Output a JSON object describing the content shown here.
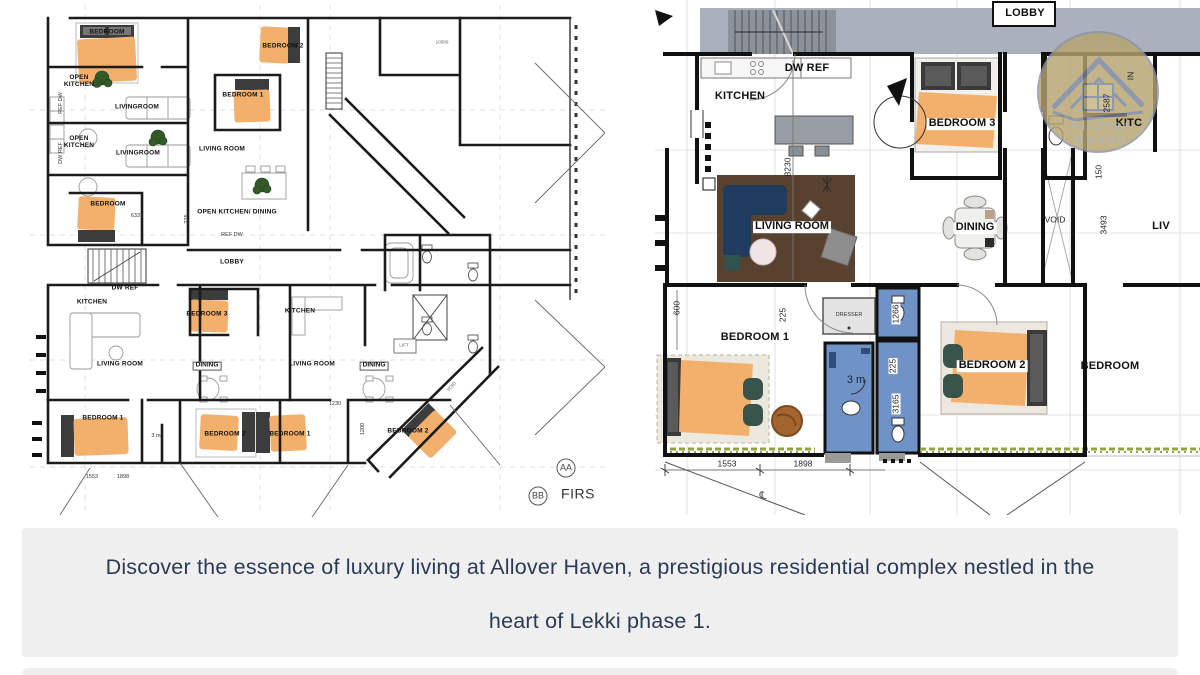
{
  "caption": {
    "lines": [
      "Discover the essence of luxury living at Allover Haven, a prestigious residential complex nestled in the",
      "heart of Lekki phase 1."
    ],
    "text_color": "#2b3a55",
    "bg_color": "#efeff0"
  },
  "brand": {
    "watermark": "Allover Haven"
  },
  "colors": {
    "bed_orange": "#f2b06c",
    "bath_blue": "#6f93c6",
    "rug_brown": "#58422f",
    "sofa_navy": "#203c5e",
    "lobby_gray": "#aab1bd",
    "stairs_gray": "#8d9199",
    "watermark_tan": "#b5a46e",
    "plant_green": "#315a28",
    "chair_green": "#39544b",
    "wall_black": "#1b1b1b"
  },
  "floorplan_left": {
    "title": "first-floor-overview-plan",
    "labels": [
      {
        "t": "BEDROOM",
        "x": 77,
        "y": 28,
        "c": "rm",
        "n": "room-label-bedroom"
      },
      {
        "t": "BEDROOM 2",
        "x": 253,
        "y": 42,
        "c": "rm",
        "n": "room-label-bedroom2"
      },
      {
        "t": "OPEN\nKITCHEN",
        "x": 49,
        "y": 77,
        "c": "rm",
        "n": "room-label-open-kitchen"
      },
      {
        "t": "LIVINGROOM",
        "x": 107,
        "y": 103,
        "c": "rm",
        "n": "room-label-livingroom"
      },
      {
        "t": "BEDROOM 1",
        "x": 213,
        "y": 91,
        "c": "rm",
        "n": "room-label-bedroom1"
      },
      {
        "t": "OPEN\nKITCHEN",
        "x": 49,
        "y": 138,
        "c": "rm",
        "n": "room-label-open-kitchen"
      },
      {
        "t": "LIVINGROOM",
        "x": 108,
        "y": 149,
        "c": "rm",
        "n": "room-label-livingroom"
      },
      {
        "t": "LIVING ROOM",
        "x": 192,
        "y": 145,
        "c": "rm",
        "n": "room-label-living-room"
      },
      {
        "t": "BEDROOM",
        "x": 78,
        "y": 200,
        "c": "rm",
        "n": "room-label-bedroom"
      },
      {
        "t": "OPEN KITCHEN/ DINING",
        "x": 207,
        "y": 208,
        "c": "rm",
        "n": "room-label-open-kitchen-dining"
      },
      {
        "t": "REF DW",
        "x": 202,
        "y": 231,
        "c": "dim",
        "n": "fixture-label"
      },
      {
        "t": "REF DW",
        "x": 32,
        "y": 98,
        "c": "dim",
        "r": -90,
        "n": "fixture-label"
      },
      {
        "t": "DW REF",
        "x": 32,
        "y": 148,
        "c": "dim",
        "r": -90,
        "n": "fixture-label"
      },
      {
        "t": "6337",
        "x": 107,
        "y": 212,
        "c": "dim",
        "n": "dim-label"
      },
      {
        "t": "225",
        "x": 158,
        "y": 214,
        "c": "dim",
        "r": -90,
        "n": "dim-label"
      },
      {
        "t": "10589",
        "x": 412,
        "y": 38,
        "c": "tiny",
        "n": "dim-label"
      },
      {
        "t": "LOBBY",
        "x": 202,
        "y": 258,
        "c": "rm",
        "n": "room-label-lobby"
      },
      {
        "t": "DW REF",
        "x": 95,
        "y": 284,
        "c": "rm",
        "n": "fixture-label"
      },
      {
        "t": "KITCHEN",
        "x": 62,
        "y": 298,
        "c": "rm",
        "n": "room-label-kitchen"
      },
      {
        "t": "BEDROOM 3",
        "x": 177,
        "y": 310,
        "c": "rm",
        "n": "room-label-bedroom3"
      },
      {
        "t": "LIVING ROOM",
        "x": 90,
        "y": 360,
        "c": "rm",
        "n": "room-label-living-room"
      },
      {
        "t": "DINING",
        "x": 177,
        "y": 361,
        "c": "rmbox",
        "n": "room-label-dining"
      },
      {
        "t": "KITCHEN",
        "x": 270,
        "y": 307,
        "c": "rm",
        "n": "room-label-kitchen"
      },
      {
        "t": "LIVING ROOM",
        "x": 282,
        "y": 360,
        "c": "rm",
        "n": "room-label-living-room"
      },
      {
        "t": "DINING",
        "x": 344,
        "y": 361,
        "c": "rmbox",
        "n": "room-label-dining"
      },
      {
        "t": "VOID",
        "x": 422,
        "y": 382,
        "c": "tiny",
        "r": -45,
        "n": "void-label"
      },
      {
        "t": "LIFT",
        "x": 374,
        "y": 341,
        "c": "tiny",
        "n": "lift-label"
      },
      {
        "t": "BEDROOM 1",
        "x": 73,
        "y": 414,
        "c": "rm",
        "n": "room-label-bedroom1"
      },
      {
        "t": "3 m",
        "x": 126,
        "y": 432,
        "c": "dim",
        "n": "bath-label"
      },
      {
        "t": "BEDROOM 2",
        "x": 195,
        "y": 430,
        "c": "rm",
        "n": "room-label-bedroom2"
      },
      {
        "t": "BEDROOM 1",
        "x": 260,
        "y": 430,
        "c": "rm",
        "n": "room-label-bedroom1"
      },
      {
        "t": "BEDROOM 2",
        "x": 378,
        "y": 427,
        "c": "rm",
        "n": "room-label-bedroom2"
      },
      {
        "t": "1230",
        "x": 305,
        "y": 400,
        "c": "dim",
        "n": "dim-label"
      },
      {
        "t": "1200",
        "x": 334,
        "y": 424,
        "c": "dim",
        "r": -90,
        "n": "dim-label"
      },
      {
        "t": "1553",
        "x": 62,
        "y": 473,
        "c": "dim",
        "n": "dim-label"
      },
      {
        "t": "1898",
        "x": 93,
        "y": 473,
        "c": "dim",
        "n": "dim-label"
      },
      {
        "t": "AA",
        "x": 536,
        "y": 463,
        "c": "sec",
        "n": "section-marker-aa"
      },
      {
        "t": "BB",
        "x": 508,
        "y": 491,
        "c": "sec",
        "n": "section-marker-bb"
      },
      {
        "t": "FIRS",
        "x": 548,
        "y": 489,
        "c": "fis",
        "n": "plan-title-cropped"
      }
    ]
  },
  "floorplan_right": {
    "title": "unit-detail-plan",
    "labels": [
      {
        "t": "LOBBY",
        "x": 370,
        "y": 14,
        "c": "RM",
        "n": "room-label-lobby"
      },
      {
        "t": "DW REF",
        "x": 152,
        "y": 69,
        "c": "RM",
        "n": "fixture-label"
      },
      {
        "t": "KITCHEN",
        "x": 85,
        "y": 97,
        "c": "RM",
        "n": "room-label-kitchen"
      },
      {
        "t": "BEDROOM 3",
        "x": 307,
        "y": 124,
        "c": "RMbox",
        "n": "room-label-bedroom3"
      },
      {
        "t": "8230",
        "x": 133,
        "y": 167,
        "c": "DIM",
        "r": -90,
        "n": "dim-label"
      },
      {
        "t": "LIVING ROOM",
        "x": 137,
        "y": 227,
        "c": "RMbox",
        "n": "room-label-living-room"
      },
      {
        "t": "DINING",
        "x": 320,
        "y": 228,
        "c": "RMbox",
        "n": "room-label-dining"
      },
      {
        "t": "VOID",
        "x": 400,
        "y": 220,
        "c": "DIM",
        "n": "void-label"
      },
      {
        "t": "IN",
        "x": 476,
        "y": 76,
        "c": "DIM",
        "r": -90,
        "n": "entry-label"
      },
      {
        "t": "2587",
        "x": 452,
        "y": 103,
        "c": "DIM",
        "r": -90,
        "n": "dim-label"
      },
      {
        "t": "KITC",
        "x": 474,
        "y": 124,
        "c": "RM",
        "n": "room-label-kitchen-cropped"
      },
      {
        "t": "150",
        "x": 444,
        "y": 172,
        "c": "DIM",
        "r": -90,
        "n": "dim-label"
      },
      {
        "t": "3493",
        "x": 449,
        "y": 225,
        "c": "DIM",
        "r": -90,
        "n": "dim-label"
      },
      {
        "t": "LIV",
        "x": 506,
        "y": 227,
        "c": "RM",
        "n": "room-label-living-cropped"
      },
      {
        "t": "Allover Haven",
        "x": 446,
        "y": 133,
        "c": "wm",
        "n": "watermark-text"
      },
      {
        "t": "600",
        "x": 22,
        "y": 308,
        "c": "DIM",
        "r": -90,
        "n": "dim-label"
      },
      {
        "t": "225",
        "x": 128,
        "y": 315,
        "c": "DIM",
        "r": -90,
        "n": "dim-label"
      },
      {
        "t": "BEDROOM 1",
        "x": 100,
        "y": 338,
        "c": "RM",
        "n": "room-label-bedroom1"
      },
      {
        "t": "DRESSER",
        "x": 194,
        "y": 316,
        "c": "dim",
        "n": "fixture-label-dresser"
      },
      {
        "t": "1266",
        "x": 241,
        "y": 314,
        "c": "DIMbox",
        "r": -90,
        "n": "dim-label"
      },
      {
        "t": "225",
        "x": 238,
        "y": 366,
        "c": "DIMbox",
        "r": -90,
        "n": "dim-label"
      },
      {
        "t": "3165",
        "x": 241,
        "y": 404,
        "c": "DIMbox",
        "r": -90,
        "n": "dim-label"
      },
      {
        "t": "3 m",
        "x": 201,
        "y": 381,
        "c": "m3",
        "n": "bath-area-label"
      },
      {
        "t": "BEDROOM 2",
        "x": 337,
        "y": 366,
        "c": "RMbox",
        "n": "room-label-bedroom2"
      },
      {
        "t": "BEDROOM",
        "x": 455,
        "y": 367,
        "c": "RM",
        "n": "room-label-bedroom-cropped"
      },
      {
        "t": "1553",
        "x": 72,
        "y": 464,
        "c": "DIM",
        "n": "dim-label"
      },
      {
        "t": "1898",
        "x": 148,
        "y": 464,
        "c": "DIM",
        "n": "dim-label"
      },
      {
        "t": "℄",
        "x": 108,
        "y": 497,
        "c": "cl",
        "n": "centerline-symbol"
      }
    ]
  }
}
